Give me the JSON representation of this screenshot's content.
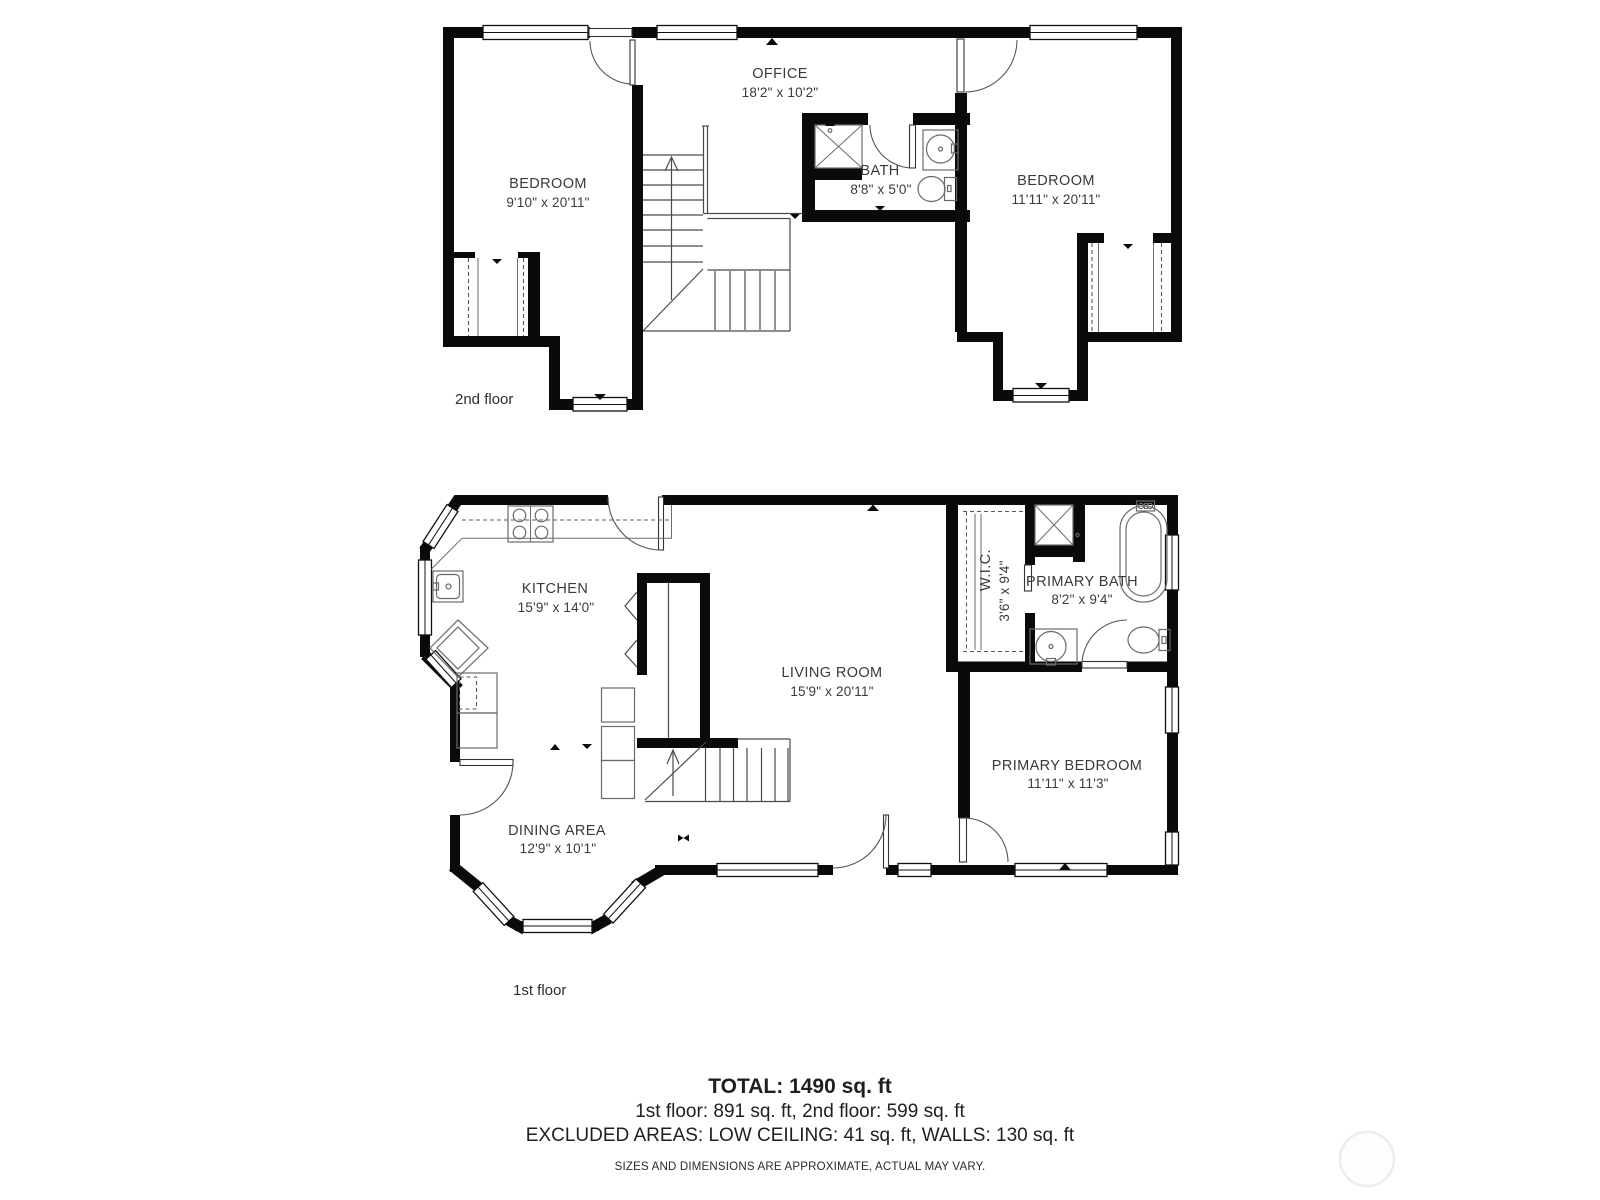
{
  "floors": [
    {
      "label": "2nd floor",
      "rooms": [
        {
          "name": "OFFICE",
          "dims": "18'2\" x 10'2\""
        },
        {
          "name": "BEDROOM",
          "dims": "9'10\" x 20'11\""
        },
        {
          "name": "BATH",
          "dims": "8'8\" x 5'0\""
        },
        {
          "name": "BEDROOM",
          "dims": "11'11\" x 20'11\""
        }
      ]
    },
    {
      "label": "1st floor",
      "rooms": [
        {
          "name": "KITCHEN",
          "dims": "15'9\" x 14'0\""
        },
        {
          "name": "LIVING ROOM",
          "dims": "15'9\" x 20'11\""
        },
        {
          "name": "DINING AREA",
          "dims": "12'9\" x 10'1\""
        },
        {
          "name": "W.I.C.",
          "dims": "3'6\" x 9'4\""
        },
        {
          "name": "PRIMARY BATH",
          "dims": "8'2\" x 9'4\""
        },
        {
          "name": "PRIMARY BEDROOM",
          "dims": "11'11\" x 11'3\""
        }
      ]
    }
  ],
  "summary": {
    "total": "TOTAL: 1490 sq. ft",
    "floors_breakdown": "1st floor: 891 sq. ft, 2nd floor: 599 sq. ft",
    "excluded": "EXCLUDED AREAS: LOW CEILING: 41 sq. ft, WALLS: 130 sq. ft",
    "disclaimer": "SIZES AND DIMENSIONS ARE APPROXIMATE, ACTUAL MAY VARY."
  },
  "colors": {
    "wall": "#0a0a0a",
    "thin_line": "#4a4a4a",
    "fixture_line": "#6a6a6a",
    "text": "#3a3a3a",
    "watermark": "#ececec"
  }
}
